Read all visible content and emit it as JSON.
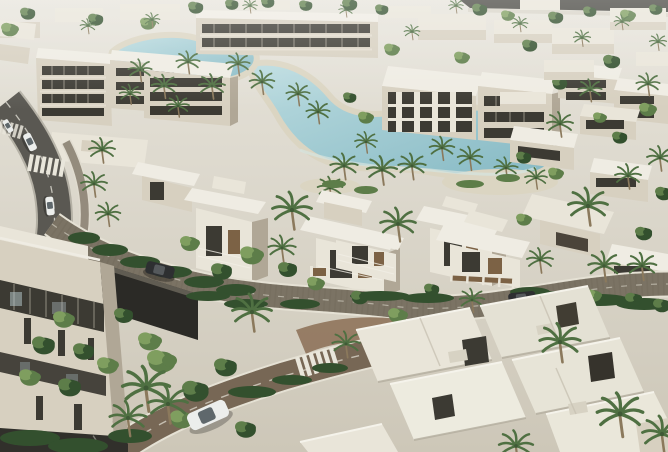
{
  "scene": {
    "type": "aerial-architectural-render",
    "aria_label": "Sunlit aerial rendering of a modern residential compound: white flat-roofed villas and beige apartment blocks around a winding turquoise lagoon with sandy beaches, palm-lined cobblestone streets, crosswalks and a few cars",
    "description": "Bright daylight CGI masterplan view seen from above at an angle; low-rise white architecture, dense palms and hedges, a curving asphalt road at left, a stone-paved loop street around central villas, a dark access lane in the lower-left foreground and large white villa roofs in the lower-right foreground.",
    "time_of_day": "bright daylight",
    "style": "photorealistic masterplan render"
  },
  "palette": {
    "bg-top": "#e7e4db",
    "bg-bottom": "#cdc7b8",
    "building-light": "#e9e5d9",
    "building-mid": "#d7d0c0",
    "building-shadow": "#b0a796",
    "roof-light": "#efece3",
    "facade-dark": "#3c3a33",
    "wood": "#7c6245",
    "water-light": "#bcdce0",
    "water-deep": "#84b8c3",
    "sand": "#dbd5c2",
    "green-dark": "#33502e",
    "green-mid": "#5d7d49",
    "green-light": "#7f9e5f",
    "palm": "#4f7042",
    "trunk": "#8b795c",
    "asphalt": "#5a5852",
    "cobble": "#7b7364",
    "cobble-red": "#86684e",
    "curb": "#e5e1d4",
    "road-dark": "#31302b",
    "marking": "#dcd8cc",
    "car-white": "#eceeec",
    "car-dark": "#2d2f31",
    "kayak-red": "#c43b2b"
  },
  "inventory": {
    "lagoon": {
      "shape": "winding, two lobes",
      "edges": "sandy beaches",
      "kayak": {
        "color": "red",
        "count": 1
      }
    },
    "vehicles": [
      {
        "type": "sedan",
        "color": "white",
        "location": "left road, top"
      },
      {
        "type": "sedan",
        "color": "white",
        "location": "left road, above crosswalk"
      },
      {
        "type": "sedan",
        "color": "white",
        "location": "left road, lower bend"
      },
      {
        "type": "suv",
        "color": "dark grey",
        "location": "curved cobble street, center-left"
      },
      {
        "type": "sedan",
        "color": "dark grey",
        "location": "street behind right-hand villas"
      },
      {
        "type": "suv",
        "color": "white",
        "location": "lower cobblestone street"
      }
    ],
    "crosswalks": 3,
    "roads": [
      "curving asphalt road entering top-left with dashed centerline",
      "stone-paved loop street sweeping around the central villas",
      "lower cobblestone street with zebra crossing and reddish paving circle",
      "dark shaded access lane in lower-left foreground"
    ],
    "buildings": {
      "apartment_blocks": "beige 3–4 storey blocks with dark ribbon windows (left cluster, top row, large central block, right-mid blocks)",
      "central_villas": "three white two-storey villas with overhanging flat roofs and wood-toned glazing",
      "right_villa_rows": "staggered rows of white flat-roofed villas with palms between",
      "foreground": "large white villa roof plates lower-right; tall beige building with dark window bands lower-left",
      "skyline": "hazy white low-rise blocks and trees along the top edge; dark road band top-right"
    },
    "vegetation": {
      "palm_trees": "about 45 scattered, largest in foreground",
      "hedges": "dark clipped hedges along streets and villa gardens",
      "trees": "bright green deciduous clusters"
    }
  }
}
